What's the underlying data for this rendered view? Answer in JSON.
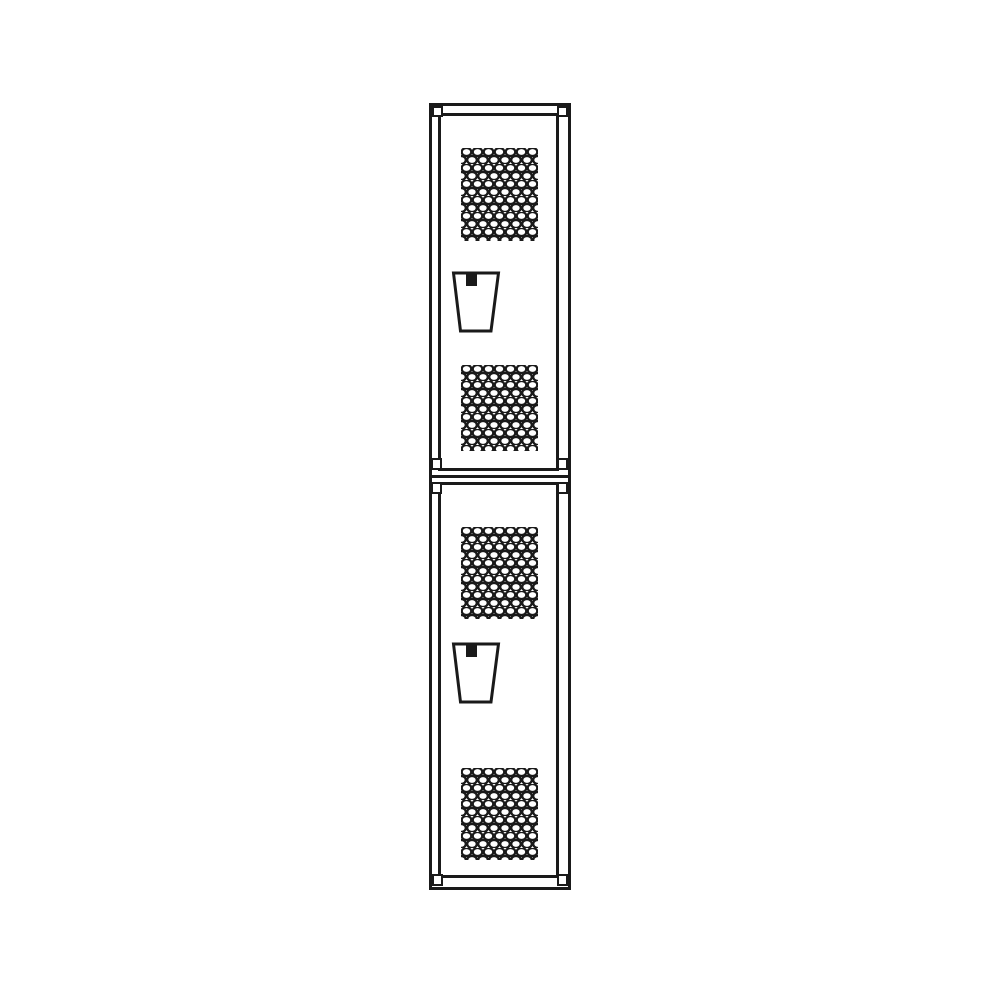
{
  "image": {
    "type": "technical line drawing",
    "subject": "single-wide double-tier locker, front elevation view",
    "background_color": "#ffffff",
    "line_color": "#1a1a1a",
    "locker": {
      "tiers": 2,
      "doors": [
        {
          "id": "upper",
          "parts": {
            "top_vent": "diamond-perforated vent panel",
            "handle": "recessed lift handle with latch",
            "bottom_vent": "diamond-perforated vent panel"
          }
        },
        {
          "id": "lower",
          "parts": {
            "top_vent": "diamond-perforated vent panel",
            "handle": "recessed lift handle with latch",
            "bottom_vent": "diamond-perforated vent panel"
          }
        }
      ]
    }
  }
}
